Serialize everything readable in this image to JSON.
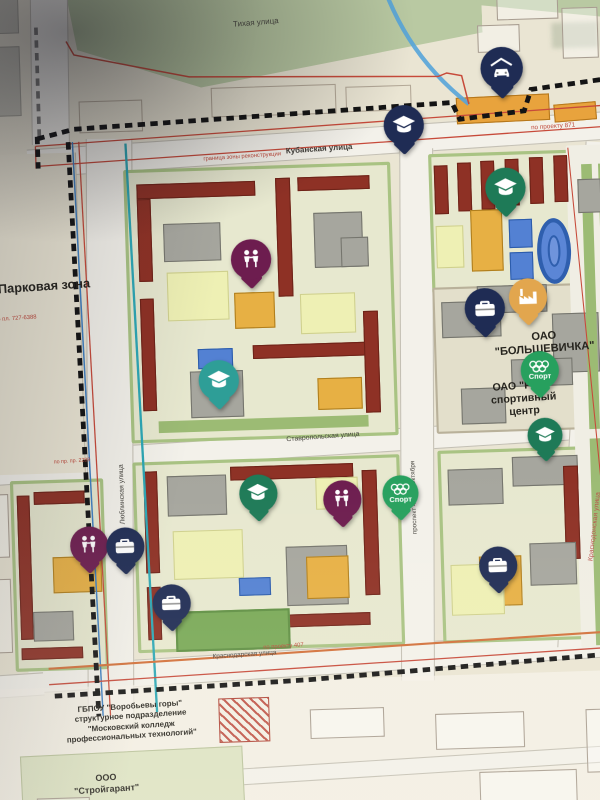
{
  "map": {
    "streets": {
      "tihaya": "Тихая улица",
      "kubanskaya": "Кубанская улица",
      "stavropolskaya": "Ставропольская улица",
      "krasnodarskaya": "Краснодарская улица",
      "lyublinskaya": "Люблинская улица",
      "prospekt": "проспект 40 лет Октября",
      "krasnodonskaya": "Краснодонская улица"
    },
    "areas": {
      "park_zone": "Парковая зона",
      "bolshevichka_line1": "ОАО",
      "bolshevichka_line2": "\"БОЛЬШЕВИЧКА\"",
      "rzd_line1": "ОАО \"РЖД\"",
      "rzd_line2": "спортивный",
      "rzd_line3": "центр",
      "college_line1": "ГБПОУ \"Воробьевы горы\"",
      "college_line2": "структурное подразделение",
      "college_line3": "\"Московский колледж",
      "college_line4": "профессиональных технологий\"",
      "stroygarant_line1": "ООО",
      "stroygarant_line2": "\"Стройгарант\""
    },
    "notes": {
      "granitsa": "граница зоны реконструкции",
      "proekt871": "по проекту 871",
      "proekt407": "по проекту 407",
      "plan727": "по пл. 727-6388",
      "pr2289": "по пр. пр. 2289"
    },
    "pins": [
      {
        "icon": "car-garage",
        "color": "navy",
        "x": 500,
        "y": 120,
        "size": 40
      },
      {
        "icon": "graduation-cap",
        "color": "navy",
        "x": 406,
        "y": 170,
        "size": 38
      },
      {
        "icon": "graduation-cap",
        "color": "green",
        "x": 500,
        "y": 232,
        "size": 38
      },
      {
        "icon": "children",
        "color": "maroon",
        "x": 258,
        "y": 292,
        "size": 38
      },
      {
        "icon": "factory",
        "color": "orange",
        "x": 518,
        "y": 335,
        "size": 36
      },
      {
        "icon": "briefcase",
        "color": "navy",
        "x": 477,
        "y": 345,
        "size": 38
      },
      {
        "icon": "sport-rings",
        "color": "sportgreen",
        "x": 527,
        "y": 404,
        "size": 36,
        "label": "Спорт"
      },
      {
        "icon": "graduation-cap",
        "color": "teal",
        "x": 224,
        "y": 405,
        "size": 38
      },
      {
        "icon": "graduation-cap",
        "color": "green",
        "x": 530,
        "y": 464,
        "size": 33
      },
      {
        "icon": "graduation-cap",
        "color": "green",
        "x": 258,
        "y": 512,
        "size": 36
      },
      {
        "icon": "children",
        "color": "maroon",
        "x": 337,
        "y": 520,
        "size": 36
      },
      {
        "icon": "sport-rings",
        "color": "sportgreen",
        "x": 392,
        "y": 515,
        "size": 34,
        "label": "Спорт"
      },
      {
        "icon": "children",
        "color": "maroon",
        "x": 97,
        "y": 556,
        "size": 36
      },
      {
        "icon": "briefcase",
        "color": "navy",
        "x": 131,
        "y": 558,
        "size": 36
      },
      {
        "icon": "briefcase",
        "color": "navy",
        "x": 173,
        "y": 613,
        "size": 36
      },
      {
        "icon": "briefcase",
        "color": "navy",
        "x": 482,
        "y": 587,
        "size": 36
      }
    ],
    "colors": {
      "pin_navy": "#1f2c54",
      "pin_green": "#1e7a57",
      "pin_teal": "#2e9e97",
      "pin_maroon": "#6d1d4f",
      "pin_orange": "#e2a64e",
      "pin_sport": "#27a05e",
      "building_red": "#8e3125",
      "building_gray": "#a6a69e",
      "building_yellow": "#e7b044",
      "courtyard_yellow": "#eef0b4",
      "sport_blue": "#5381d3",
      "park_green": "#b9c9a2",
      "lawn_green": "#9cbb74",
      "boundary_red": "#c74a3a",
      "boundary_black": "#141414",
      "water_blue": "#57a4d9",
      "road": "#f3f1ea"
    }
  }
}
